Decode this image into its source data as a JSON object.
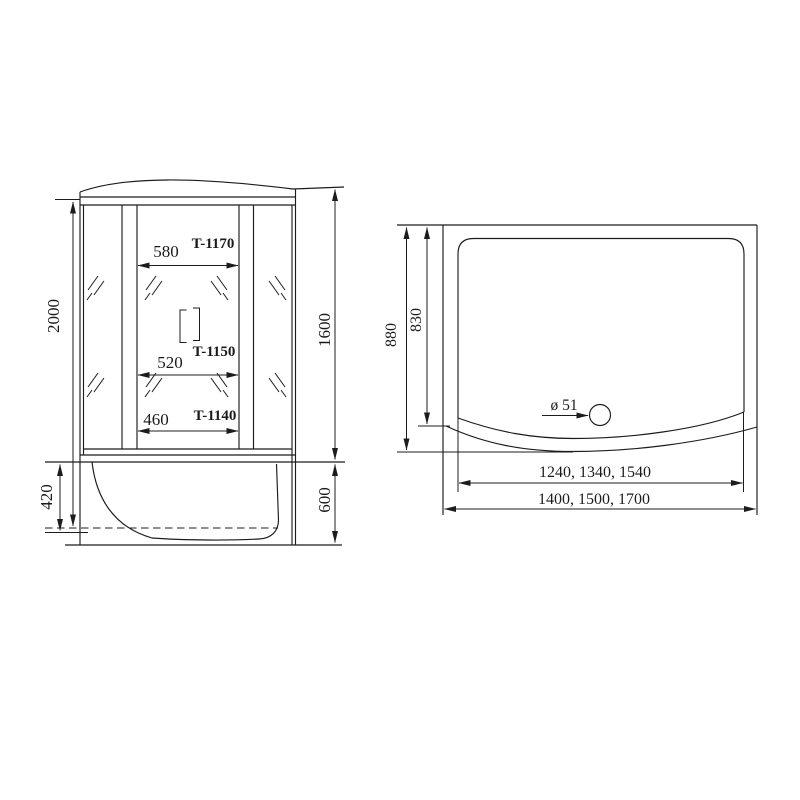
{
  "drawing": {
    "front_view": {
      "overall_height": "2000",
      "body_height": "1600",
      "tray_inner_depth": "420",
      "tray_height": "600",
      "models": [
        {
          "label": "T-1170",
          "door_width": "580"
        },
        {
          "label": "T-1150",
          "door_width": "520"
        },
        {
          "label": "T-1140",
          "door_width": "460"
        }
      ]
    },
    "top_view": {
      "outer_depth": "880",
      "inner_depth": "830",
      "drain_diameter": "ø 51",
      "inner_widths": "1240, 1340, 1540",
      "outer_widths": "1400, 1500, 1700"
    }
  }
}
